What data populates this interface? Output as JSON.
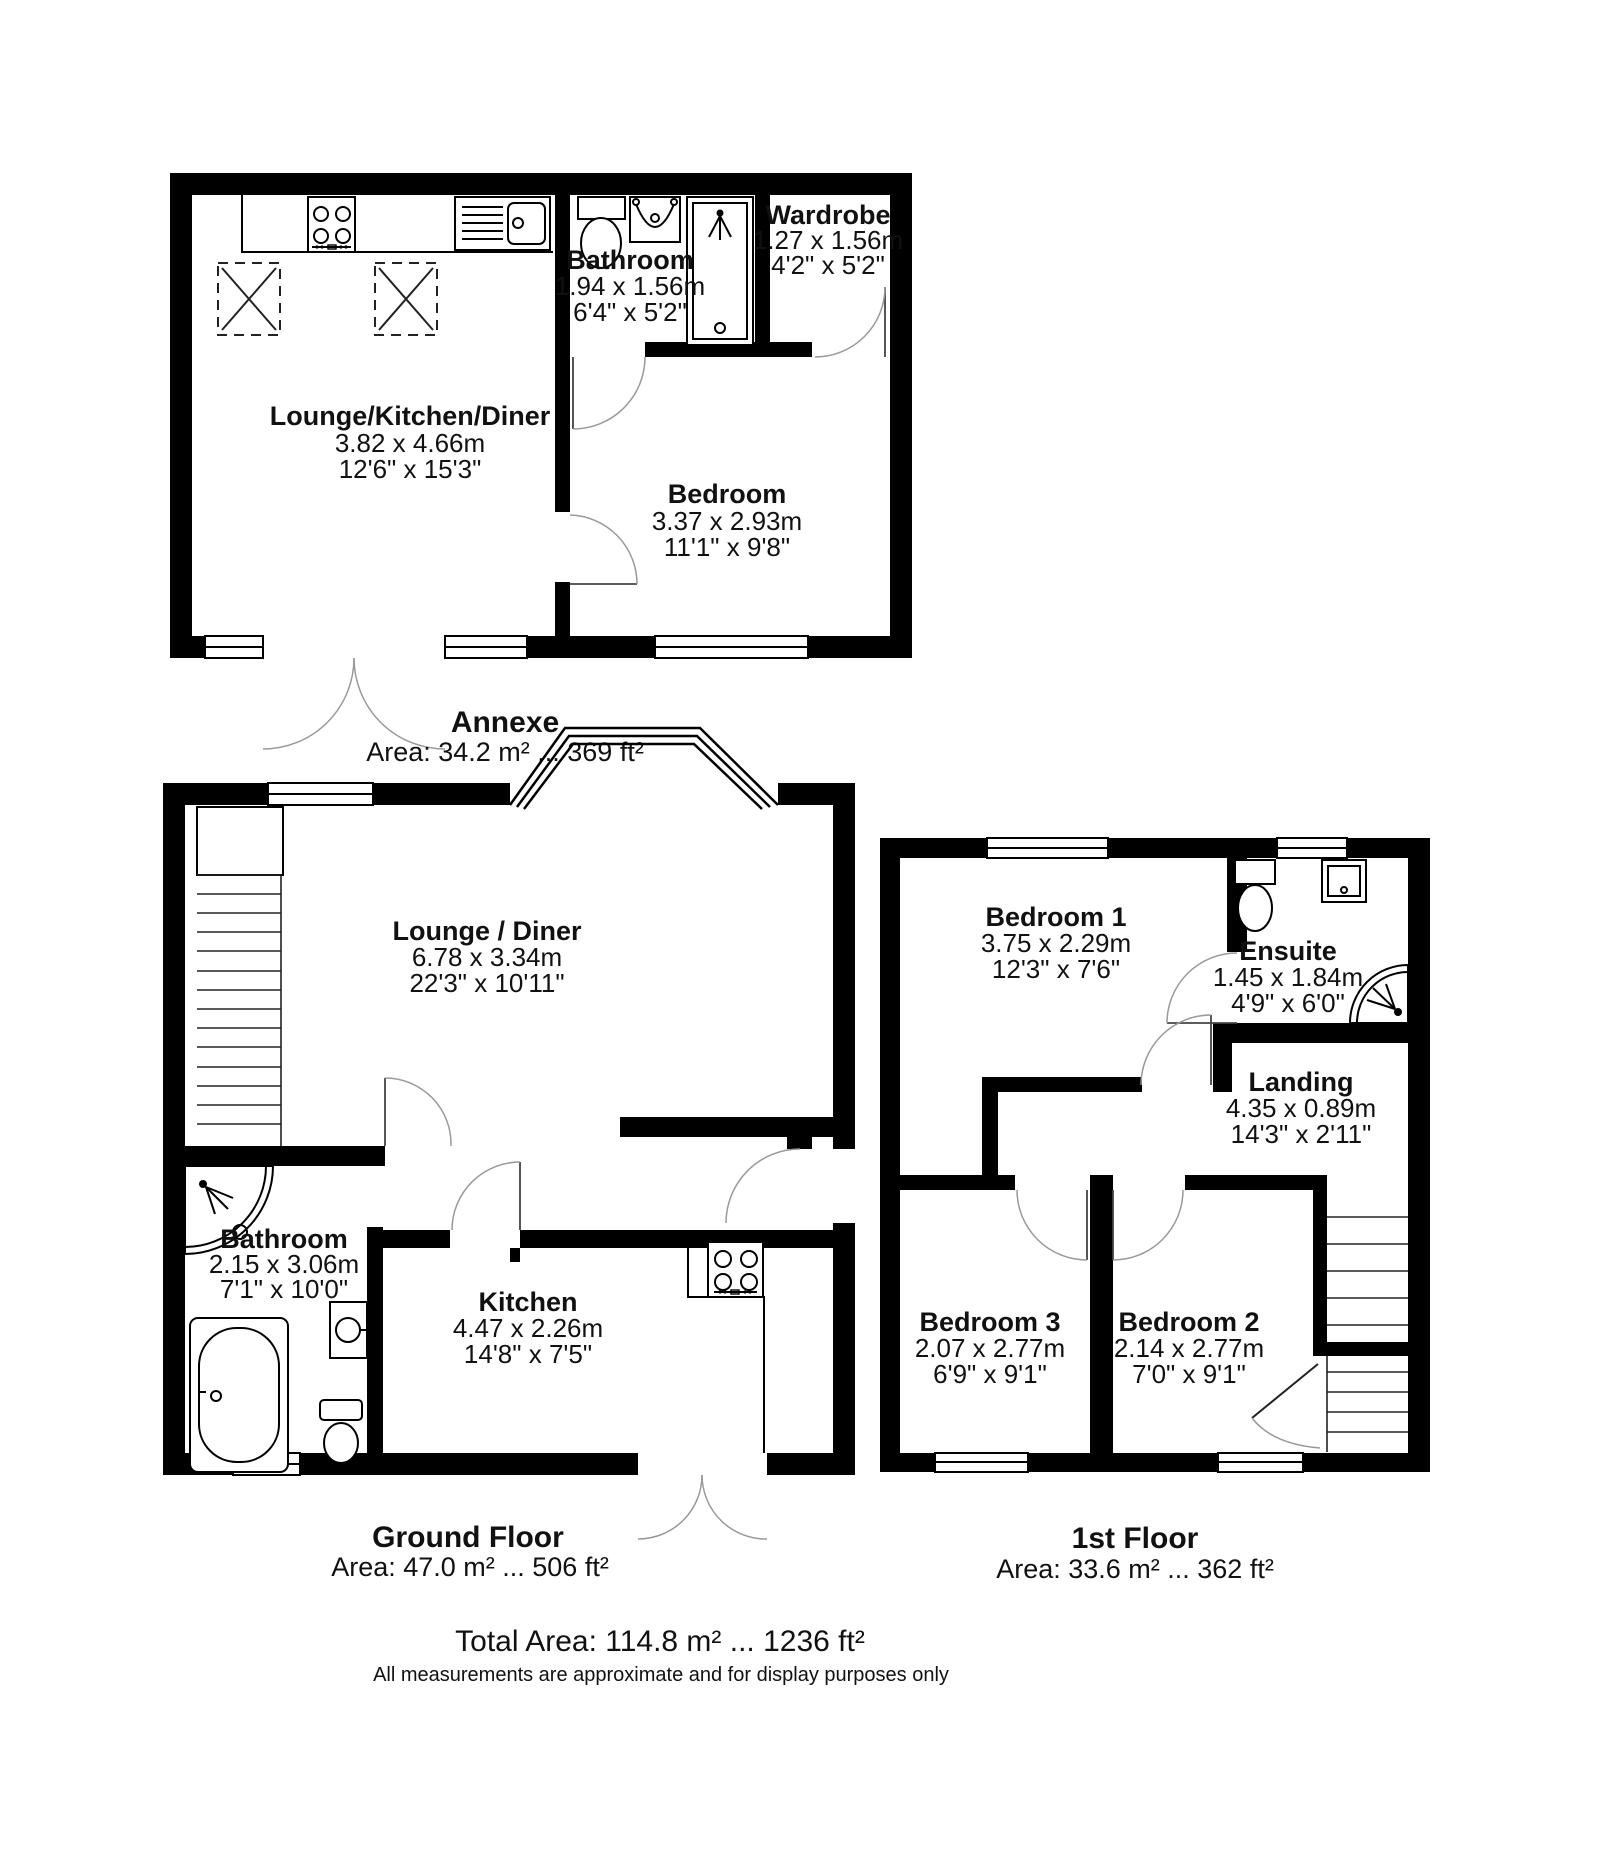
{
  "floors": [
    {
      "id": "annexe",
      "title": "Annexe",
      "area": "Area: 34.2 m² ... 369 ft²",
      "rooms": [
        {
          "name": "Lounge/Kitchen/Diner",
          "metric": "3.82 x 4.66m",
          "imperial": "12'6\" x 15'3\""
        },
        {
          "name": "Bathroom",
          "metric": "1.94 x 1.56m",
          "imperial": "6'4\" x 5'2\""
        },
        {
          "name": "Wardrobe",
          "metric": "1.27 x 1.56m",
          "imperial": "4'2\" x 5'2\""
        },
        {
          "name": "Bedroom",
          "metric": "3.37 x 2.93m",
          "imperial": "11'1\" x 9'8\""
        }
      ]
    },
    {
      "id": "ground-floor",
      "title": "Ground Floor",
      "area": "Area: 47.0 m² ... 506 ft²",
      "rooms": [
        {
          "name": "Lounge / Diner",
          "metric": "6.78 x 3.34m",
          "imperial": "22'3\" x 10'11\""
        },
        {
          "name": "Bathroom",
          "metric": "2.15 x 3.06m",
          "imperial": "7'1\" x 10'0\""
        },
        {
          "name": "Kitchen",
          "metric": "4.47 x 2.26m",
          "imperial": "14'8\" x 7'5\""
        }
      ]
    },
    {
      "id": "first-floor",
      "title": "1st Floor",
      "area": "Area: 33.6 m² ... 362 ft²",
      "rooms": [
        {
          "name": "Bedroom 1",
          "metric": "3.75 x 2.29m",
          "imperial": "12'3\" x 7'6\""
        },
        {
          "name": "Ensuite",
          "metric": "1.45 x 1.84m",
          "imperial": "4'9\" x 6'0\""
        },
        {
          "name": "Landing",
          "metric": "4.35 x 0.89m",
          "imperial": "14'3\" x 2'11\""
        },
        {
          "name": "Bedroom 3",
          "metric": "2.07 x 2.77m",
          "imperial": "6'9\" x 9'1\""
        },
        {
          "name": "Bedroom 2",
          "metric": "2.14 x 2.77m",
          "imperial": "7'0\" x 9'1\""
        }
      ]
    }
  ],
  "footer": {
    "total": "Total Area: 114.8 m² ... 1236 ft²",
    "disclaimer": "All measurements are approximate and for display purposes only"
  },
  "colors": {
    "wall": "#000000",
    "background": "#ffffff",
    "door_arc": "#999999"
  }
}
